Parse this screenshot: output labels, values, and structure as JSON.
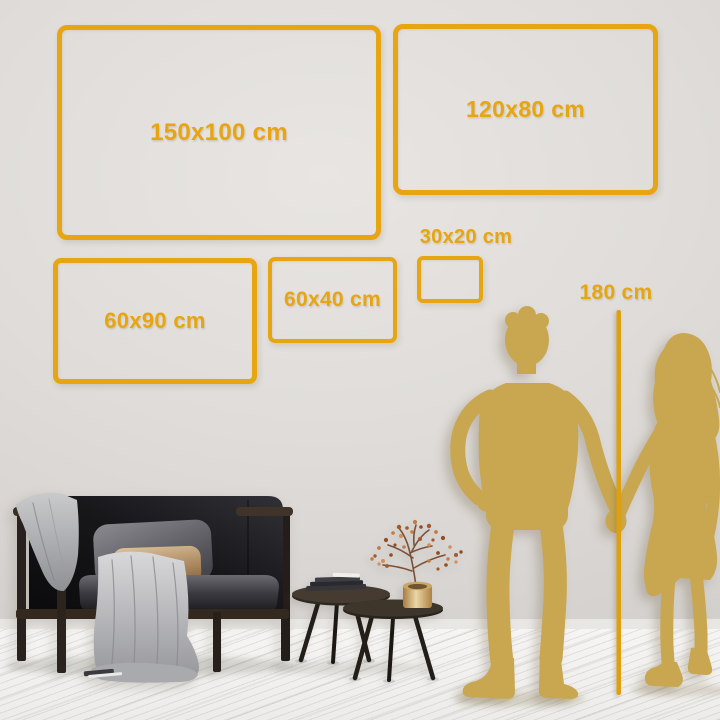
{
  "colors": {
    "accent_gold": "#E7A512",
    "ruler_gold": "#DFA00E",
    "silhouette_gold": "#C8A750"
  },
  "size_frames": [
    {
      "id": "150x100",
      "label": "150x100 cm"
    },
    {
      "id": "120x80",
      "label": "120x80 cm"
    },
    {
      "id": "60x90",
      "label": "60x90 cm"
    },
    {
      "id": "60x40",
      "label": "60x40 cm"
    },
    {
      "id": "30x20",
      "label": "30x20 cm"
    }
  ],
  "height_ruler": {
    "label": "180 cm"
  }
}
